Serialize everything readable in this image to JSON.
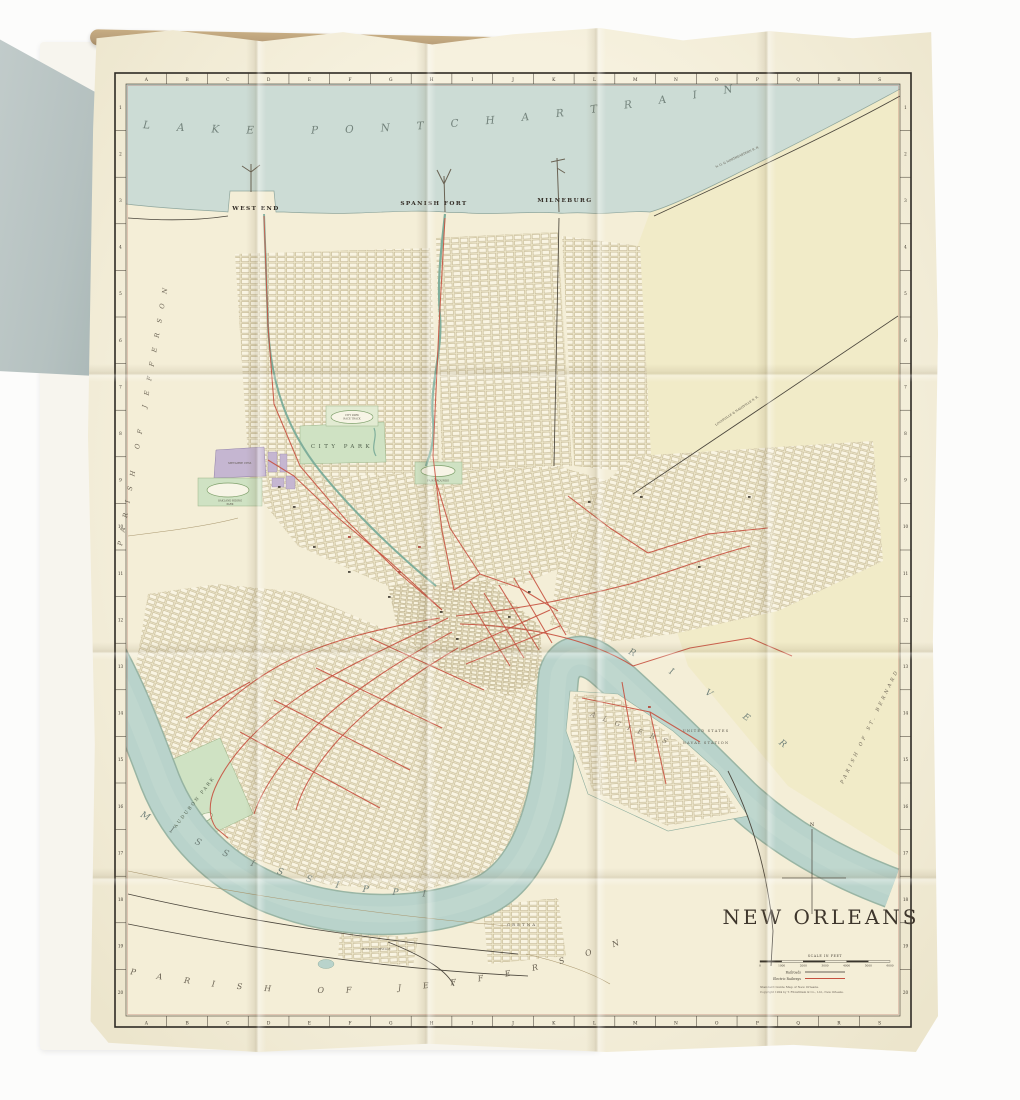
{
  "photo": {
    "background_color": "#fcfcfb"
  },
  "book": {
    "cover_color": "#b5c1c0",
    "page_color": "#f7f5ee",
    "page_edge_color": "#b89e79"
  },
  "map": {
    "title": "NEW ORLEANS",
    "colors": {
      "sheet": "#f3eedb",
      "lake_water": "#ccdcd5",
      "river_water": "#b9d3cb",
      "land": "#f4eed7",
      "land_east": "#f1eac6",
      "park_green": "#cfe2c3",
      "cemetery_purple": "#c5b6d1",
      "electric_railway_red": "#c6513f",
      "railroad_black": "#4b463c",
      "canal_green": "#7fae9b",
      "border_ink": "#2e2a24"
    },
    "labels": {
      "lake": "LAKE PONTCHARTRAIN",
      "river_upper": "MISSISSIPPI",
      "river_lower": "RIVER",
      "west_end": "WEST END",
      "spanish_fort": "SPANISH FORT",
      "milneburg": "MILNEBURG",
      "parish_left": "PARISH OF JEFFERSON",
      "parish_bottom": "PARISH OF JEFFERSON",
      "parish_right": "PARISH OF ST. BERNARD",
      "city_park": "CITY PARK",
      "race_track_line1": "CITY PARK",
      "race_track_line2": "RACE TRACK",
      "fair_grounds": "FAIR GROUNDS",
      "metairie_cemetery": "METAIRIE CEM.",
      "oakland_line1": "OAKLAND RIDING",
      "oakland_line2": "PARK",
      "audubon": "AUDUBON PARK",
      "algiers": "ALGIERS",
      "gretna": "GRETNA",
      "mcdonoghville": "McDONOGHVILLE",
      "naval_line1": "UNITED STATES",
      "naval_line2": "NAVAL STATION",
      "rr_shore": "N. O. & NORTHEASTERN R. R.",
      "rr_diagonal": "LOUISVILLE & NASHVILLE R. R.",
      "compass_north": "N"
    },
    "grid": {
      "letters": [
        "A",
        "B",
        "C",
        "D",
        "E",
        "F",
        "G",
        "H",
        "I",
        "J",
        "K",
        "L",
        "M",
        "N",
        "O",
        "P",
        "Q",
        "R",
        "S"
      ],
      "rows": [
        "1",
        "2",
        "3",
        "4",
        "5",
        "6",
        "7",
        "8",
        "9",
        "10",
        "11",
        "12",
        "13",
        "14",
        "15",
        "16",
        "17",
        "18",
        "19",
        "20"
      ]
    },
    "scale": {
      "caption": "SCALE IN FEET",
      "ticks": [
        "0",
        "1000",
        "2000",
        "3000",
        "4000",
        "5000",
        "6000"
      ]
    },
    "legend": [
      {
        "label": "Railroads",
        "color": "#3a352c"
      },
      {
        "label": "Electric Railways",
        "color": "#c6513f"
      }
    ],
    "credits": [
      "Standard Guide Map of New Orleans.",
      "Copyright 1904 by T. Fitzwilliam & Co., Ltd., New Orleans."
    ]
  }
}
